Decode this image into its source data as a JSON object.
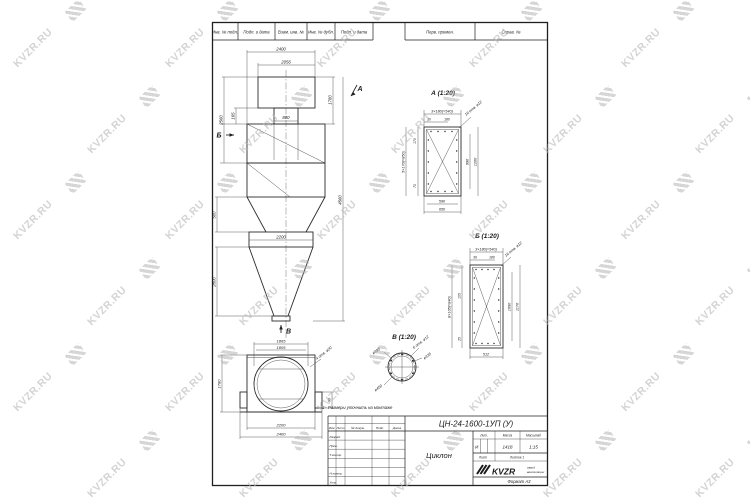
{
  "watermark": {
    "text": "KVZR.RU"
  },
  "top_strip": {
    "cells": [
      "Инв. № подл.",
      "Подп. и дата",
      "Взам. инв. №",
      "Инв. № дубл.",
      "Подп. и дата"
    ],
    "perv": "Перв. примен.",
    "sprav": "Справ. №"
  },
  "main_view": {
    "dim_2400": "2400",
    "dim_2056": "2056",
    "dim_165": "165",
    "dim_1780": "1780",
    "dim_800": "800",
    "dim_2560": "2560",
    "dim_500": "500",
    "dim_2800": "2800",
    "dim_2200": "2200",
    "dim_total": "4560",
    "arrow_a": "А",
    "arrow_b": "Б",
    "arrow_v": "В"
  },
  "view_a": {
    "title": "А (1:20)",
    "dim_row": "3×180(=540)",
    "dim_30": "30",
    "dim_180": "180",
    "holes": "16 отв. ø12",
    "dim_col": "5×170(=850)",
    "dim_170": "170",
    "dim_70": "70",
    "dim_990": "990",
    "dim_1200": "1200",
    "dim_590": "590",
    "dim_650": "650"
  },
  "view_b": {
    "title": "Б (1:20)",
    "dim_row": "3×180(=540)",
    "dim_36": "36",
    "dim_180": "180",
    "holes": "16 отв. ø12",
    "dim_col": "8×105(=840)",
    "dim_105": "105",
    "dim_25": "25",
    "dim_1090": "1090",
    "dim_1170": "1170",
    "dim_512": "512"
  },
  "view_v": {
    "title": "В (1:20)",
    "holes": "6 отв. ø12",
    "d450": "ø450",
    "d395": "ø395",
    "d335": "ø335"
  },
  "bottom_view": {
    "dim_1865": "1865",
    "dim_1805": "1805",
    "dim_1780": "1780",
    "dim_90": "90",
    "holes": "4 отв. ø20",
    "dim_2200": "2200",
    "dim_2400": "2400"
  },
  "note": "1 - Размеры уточнить на монтаже",
  "title_block": {
    "designation": "ЦН-24-1600-1УП (У)",
    "name": "Циклон",
    "header_cols": [
      "Изм.",
      "Лист",
      "№ докум.",
      "Подп.",
      "Дата"
    ],
    "rows": [
      "Разраб.",
      "Пров.",
      "Т.контр.",
      "Н.контр.",
      "Утв."
    ],
    "lit_label": "Лит.",
    "lit_value": "И",
    "mass_label": "Масса",
    "mass_value": "1418",
    "scale_label": "Масштаб",
    "scale_value": "1:15",
    "sheet_label": "Лист",
    "sheets_label": "Листов 1",
    "logo": "KVZR",
    "logo_sub1": "завод",
    "logo_sub2": "вентиляции",
    "format": "Формат А3"
  }
}
